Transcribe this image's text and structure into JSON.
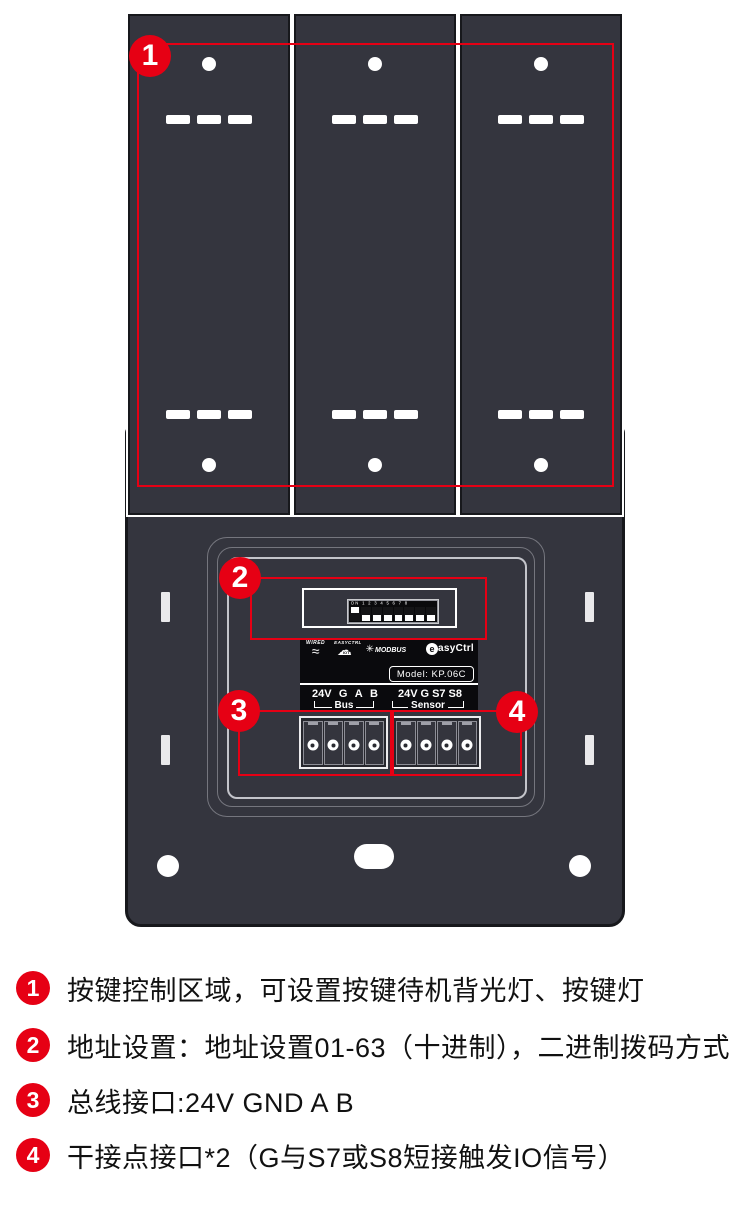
{
  "colors": {
    "accent_red": "#e60014",
    "device_body": "#34353e",
    "device_border": "#17181c",
    "label_bg": "#0a0a0d"
  },
  "callouts": [
    {
      "num": "1",
      "label": "按键控制区域，可设置按键待机背光灯、按键灯"
    },
    {
      "num": "2",
      "label": "地址设置：地址设置01-63（十进制），二进制拨码方式"
    },
    {
      "num": "3",
      "label": "总线接口:24V GND A B"
    },
    {
      "num": "4",
      "label": "干接点接口*2（G与S7或S8短接触发IO信号）"
    }
  ],
  "device": {
    "dip": {
      "legend": "ON 1 2 3 4 5 6 7 8",
      "states": [
        "on",
        "off",
        "off",
        "off",
        "off",
        "off",
        "off",
        "off"
      ]
    },
    "label": {
      "wired": "WIRED",
      "wired_wave": "≈",
      "easyctrl": "EASYCTRL",
      "iot": "IOT",
      "modbus": "MODBUS",
      "modbus_icon": "✳",
      "brand_initial": "e",
      "brand": "asyCtrl",
      "model": "Model: KP.06C",
      "bus_pins": [
        "24V",
        "G",
        "A",
        "B"
      ],
      "sensor_pins": [
        "24V",
        "G",
        "S7",
        "S8"
      ],
      "bus": "Bus",
      "sensor": "Sensor"
    }
  }
}
